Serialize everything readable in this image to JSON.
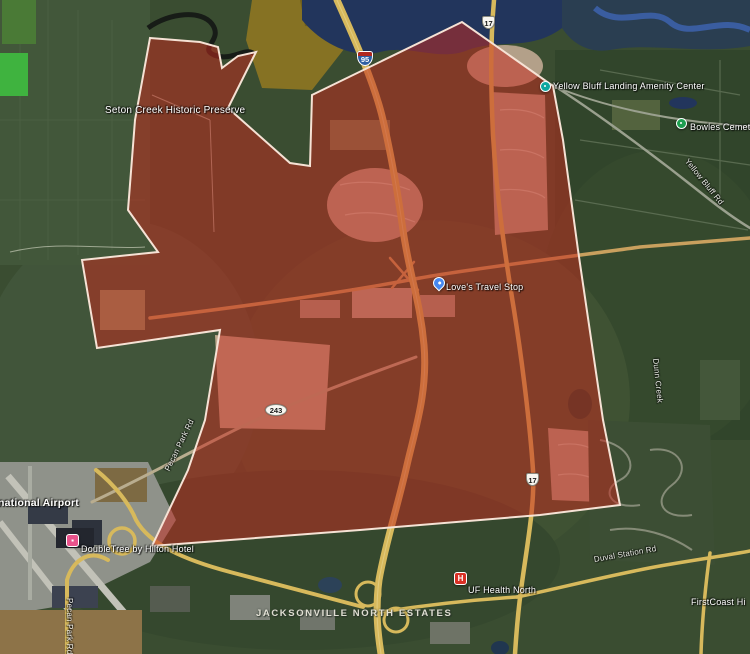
{
  "overlay": {
    "points": "150,38 200,42 218,47 222,68 238,56 256,52 228,108 290,163 310,166 312,95 462,22 553,86 563,140 578,250 603,420 620,505 540,515 360,530 152,546 188,470 205,420 220,330 97,348 82,260 158,252 128,210 135,120",
    "fill": "#c32b1e",
    "fill_opacity": "0.52",
    "stroke": "#f6e2d5",
    "stroke_width": "2"
  },
  "labels": {
    "seton_creek": {
      "text": "Seton Creek Historic Preserve"
    },
    "amenity_center": {
      "text": "Yellow Bluff Landing Amenity Center"
    },
    "bowles_cemetery": {
      "text": "Bowles Cemetery"
    },
    "loves": {
      "text": "Love's Travel Stop"
    },
    "airport": {
      "text": "national Airport"
    },
    "doubletree": {
      "text": "DoubleTree by Hilton Hotel"
    },
    "jacksonville_north_estates": {
      "text": "JACKSONVILLE NORTH ESTATES"
    },
    "uf_health": {
      "text": "UF Health North"
    },
    "duval_station_rd": {
      "text": "Duval Station Rd"
    },
    "firstcoast": {
      "text": "FirstCoast Hi"
    },
    "dunn_creek": {
      "text": "Dunn Creek"
    },
    "yellow_bluff_rd": {
      "text": "Yellow Bluff Rd"
    },
    "pecan_park_rd_mid": {
      "text": "Pecan Park Rd"
    },
    "pecan_park_rd_south": {
      "text": "Pecan Park Rd"
    }
  },
  "shields": {
    "i95": {
      "number": "95"
    },
    "us17_north": {
      "number": "17"
    },
    "us17_south": {
      "number": "17"
    },
    "fl243": {
      "number": "243"
    }
  },
  "markers": {
    "amenity": {
      "color": "#0ea7a0"
    },
    "cemetery": {
      "color": "#1e9e50"
    },
    "loves_pin": {
      "color": "#4688f1"
    },
    "hotel": {
      "color": "#e9538c"
    },
    "hospital": {
      "color": "#d93025",
      "letter": "H"
    }
  }
}
